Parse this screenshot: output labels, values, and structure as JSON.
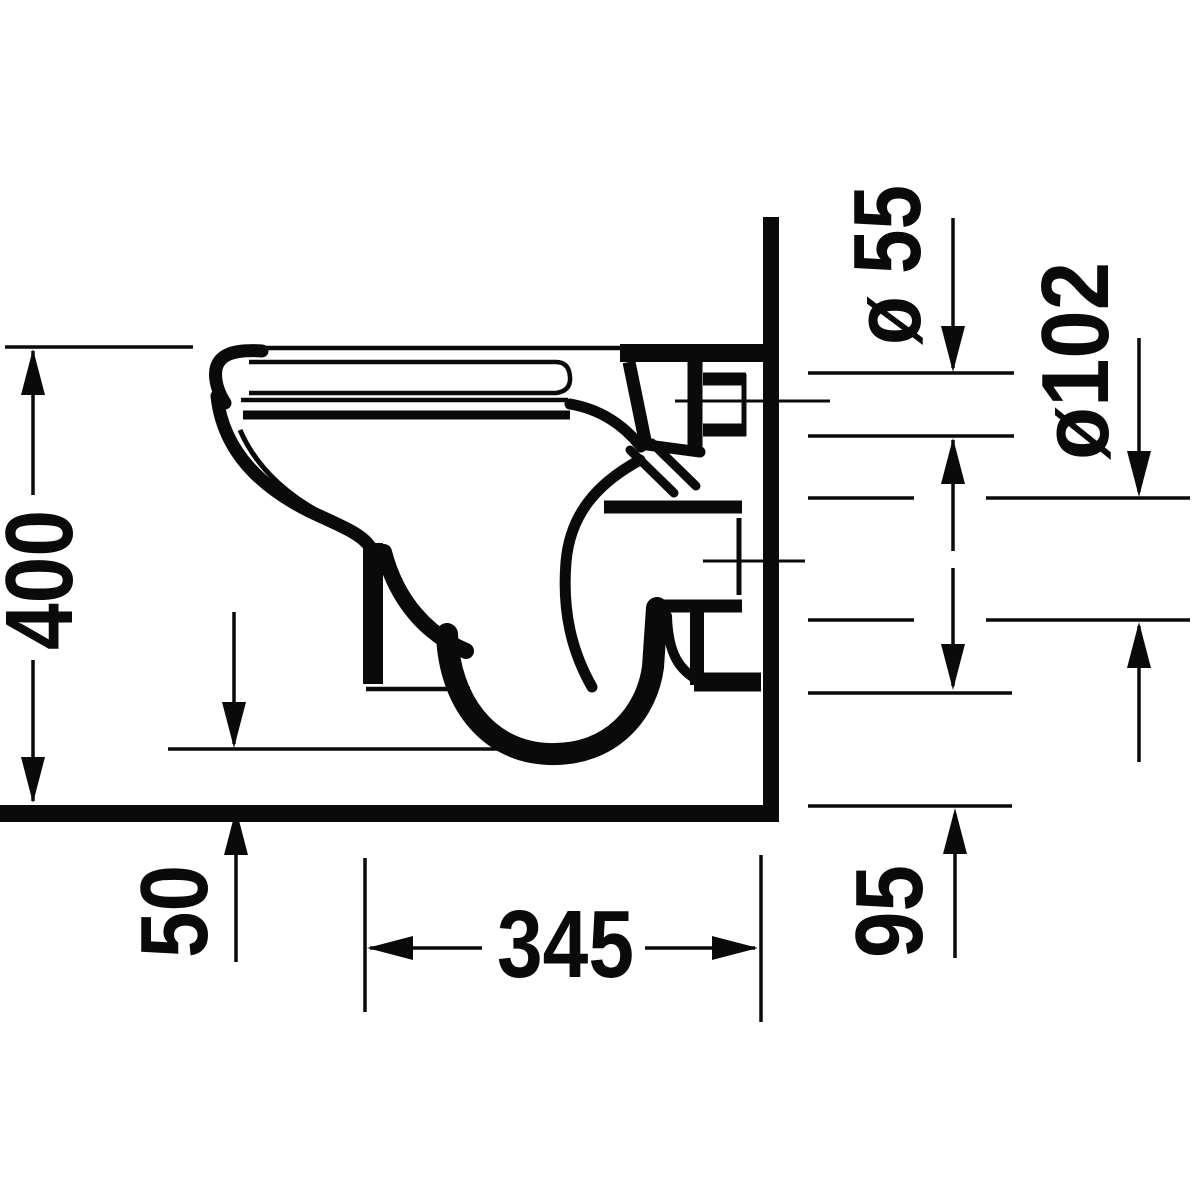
{
  "title": "Technical drawing — wall-hung toilet, side elevation with installation dimensions",
  "drawing": {
    "background": "#ffffff",
    "line_color": "#0a0a0a",
    "units": "mm",
    "labels": {
      "overall_height": "400",
      "floor_clearance": "50",
      "bottom_depth": "345",
      "outlet_clearance": "95",
      "inlet_diameter": "ø 55",
      "outlet_diameter": "ø102"
    }
  }
}
